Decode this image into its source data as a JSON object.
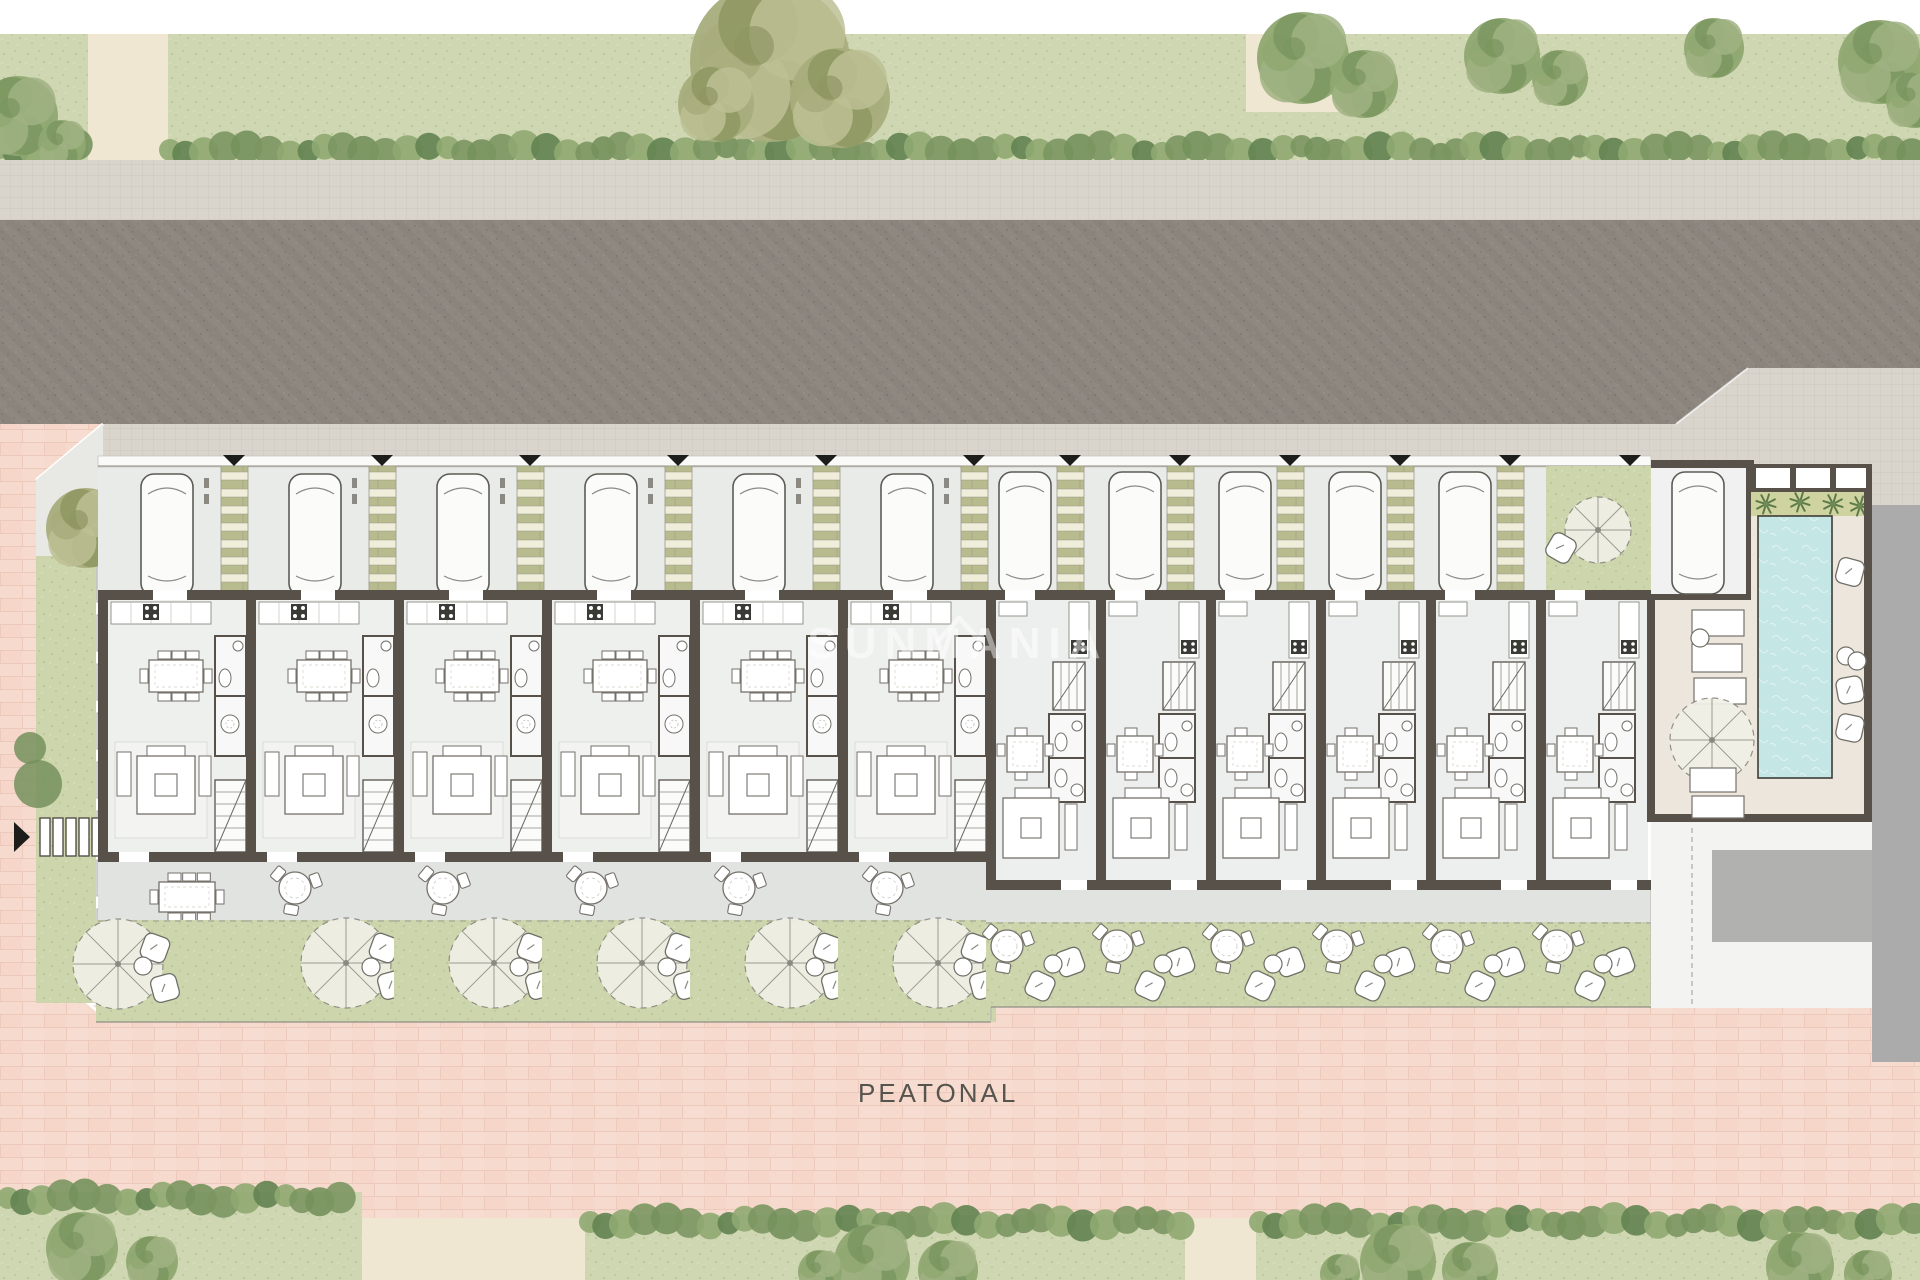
{
  "meta": {
    "type": "architectural-site-plan",
    "floor": "ground-floor",
    "canvas_width": 1920,
    "canvas_height": 1280
  },
  "labels": {
    "pedestrian_street": "PEATONAL",
    "watermark": "SUNMANIA"
  },
  "colors": {
    "road": "#8e8881",
    "sidewalk": "#d9d4cc",
    "paving_pink": "#f6dacd",
    "lawn": "#cfd6b2",
    "garden": "#ccd5ab",
    "wall": "#57514a",
    "floor": "#eef0ee",
    "carport": "#e9ebe9",
    "stripe_green": "#b8bb8e",
    "stripe_cream": "#f0eddb",
    "water": "#c4e6e4",
    "deck": "#ede6dc",
    "terrace": "#e1e3e1",
    "neighbor_gray": "#ababab",
    "cream_path": "#efe7d2",
    "marker_black": "#1d1d1b",
    "furniture_stroke": "#75716a",
    "white": "#ffffff"
  },
  "units": {
    "total": 12,
    "type_a": {
      "count": 6,
      "bay_x": [
        103,
        251,
        399,
        547,
        695,
        843
      ],
      "pitch": 148,
      "rooms": [
        "carport",
        "kitchen",
        "dining",
        "wc",
        "shower",
        "stairs",
        "living",
        "terrace",
        "garden"
      ]
    },
    "type_b": {
      "count": 6,
      "bay_x": [
        991,
        1101,
        1211,
        1321,
        1431,
        1541
      ],
      "pitch": 110,
      "rooms": [
        "carport",
        "kitchen",
        "stairs",
        "bathroom",
        "bathroom",
        "dining",
        "living",
        "terrace",
        "garden"
      ]
    },
    "last_bay_front_patio": true
  },
  "amenities": {
    "pool": {
      "x": 1758,
      "y": 516,
      "w": 74,
      "h": 262
    },
    "garage": {
      "x": 1651,
      "y": 466,
      "w": 100,
      "h": 134
    },
    "lounge_terrace": true,
    "sun_pillow_count": 4
  },
  "vegetation": {
    "top_trees": [
      [
        18,
        116,
        40,
        "g"
      ],
      [
        62,
        144,
        24,
        "g"
      ],
      [
        770,
        62,
        80,
        "o"
      ],
      [
        840,
        98,
        50,
        "o"
      ],
      [
        716,
        104,
        38,
        "o"
      ],
      [
        1303,
        58,
        46,
        "g"
      ],
      [
        1364,
        84,
        34,
        "g"
      ],
      [
        1502,
        56,
        38,
        "g"
      ],
      [
        1560,
        78,
        28,
        "g"
      ],
      [
        1714,
        48,
        30,
        "g"
      ],
      [
        1880,
        62,
        42,
        "g"
      ],
      [
        1914,
        100,
        28,
        "g"
      ]
    ],
    "corner_tree": [
      86,
      528,
      40,
      "o"
    ],
    "bottom_trees": [
      [
        82,
        1248,
        36,
        "g"
      ],
      [
        152,
        1262,
        26,
        "g"
      ],
      [
        872,
        1262,
        38,
        "g"
      ],
      [
        948,
        1270,
        30,
        "g"
      ],
      [
        820,
        1272,
        22,
        "g"
      ],
      [
        1398,
        1262,
        38,
        "g"
      ],
      [
        1470,
        1270,
        28,
        "g"
      ],
      [
        1340,
        1274,
        20,
        "g"
      ],
      [
        1800,
        1266,
        34,
        "g"
      ],
      [
        1868,
        1274,
        24,
        "g"
      ]
    ],
    "strip_bushes": [
      [
        38,
        784,
        24
      ],
      [
        30,
        748,
        16
      ]
    ]
  },
  "paths": {
    "top_path_1": [
      88,
      34,
      80,
      126
    ],
    "top_path_2": [
      1246,
      34,
      96,
      78
    ]
  }
}
